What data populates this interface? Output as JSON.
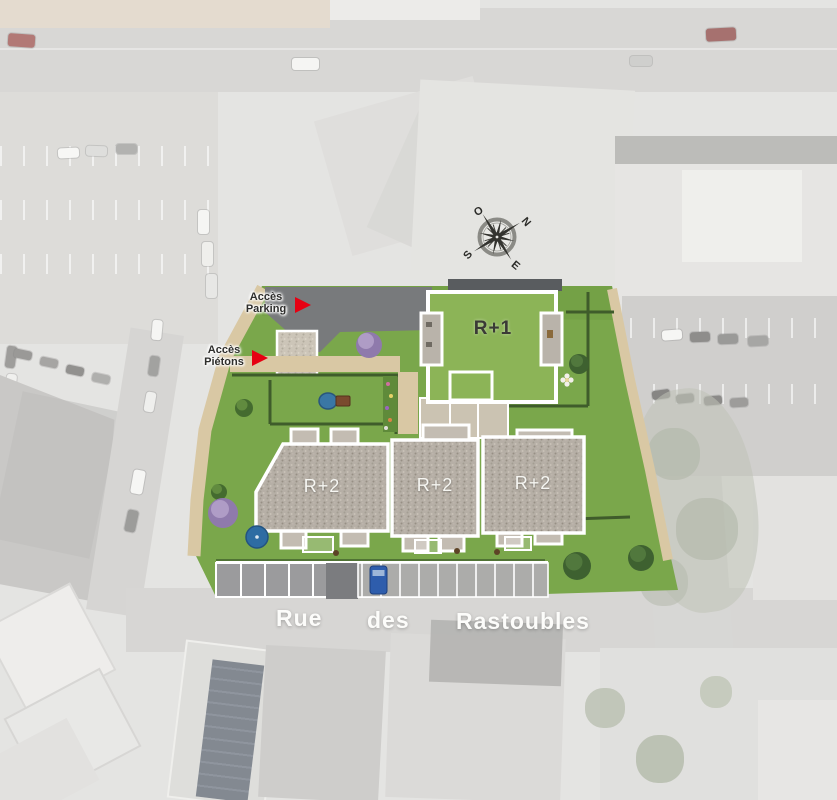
{
  "site_plan": {
    "compass": {
      "north": "N",
      "east": "E",
      "south": "S",
      "west": "O"
    },
    "access": {
      "parking": {
        "line1": "Accès",
        "line2": "Parking"
      },
      "pedestrian": {
        "line1": "Accès",
        "line2": "Piétons"
      }
    },
    "buildings": [
      {
        "id": "north-building",
        "label": "R+1"
      },
      {
        "id": "west-building",
        "label": "R+2"
      },
      {
        "id": "center-building",
        "label": "R+2"
      },
      {
        "id": "east-building",
        "label": "R+2"
      }
    ],
    "street": {
      "words": [
        "Rue",
        "des",
        "Rastoubles"
      ]
    },
    "colors": {
      "accent_red": "#e60012",
      "lawn_green": "#7aa74b",
      "roof_green": "#8cb457",
      "gravel_roof": "#b6afa6",
      "path_tan": "#d9c8a4",
      "pond_blue": "#3a77a5",
      "car_blue": "#2e5dac"
    }
  }
}
